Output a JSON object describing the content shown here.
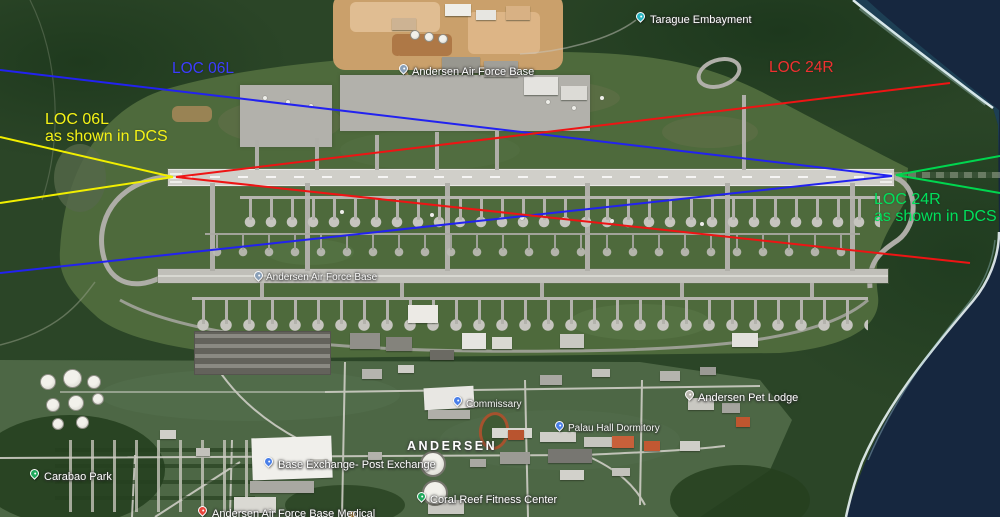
{
  "map": {
    "description": "Satellite view of Andersen Air Force Base, Guam, with localizer comparison overlay"
  },
  "annotations": {
    "colors": {
      "loc06l_real": "#2e2ef5",
      "loc24r_real": "#ee1414",
      "loc06l_dcs": "#f2ef0a",
      "loc24r_dcs": "#00d64f"
    },
    "texts": [
      {
        "id": "loc06l-real",
        "lines": [
          "LOC 06L"
        ],
        "color": "#3c3cff",
        "x": 172,
        "y": 61,
        "size": 15.5
      },
      {
        "id": "loc24r-real",
        "lines": [
          "LOC 24R"
        ],
        "color": "#f03030",
        "x": 769,
        "y": 60,
        "size": 15.5
      },
      {
        "id": "loc06l-dcs",
        "lines": [
          "LOC 06L",
          "as shown in DCS"
        ],
        "color": "#f5f216",
        "x": 45,
        "y": 111,
        "size": 16
      },
      {
        "id": "loc24r-dcs",
        "lines": [
          "LOC 24R",
          "as shown in DCS"
        ],
        "color": "#00e05c",
        "x": 874,
        "y": 191,
        "size": 16
      }
    ],
    "lines": [
      {
        "id": "loc06l-real-upper",
        "color": "#2222f0",
        "x1": 0,
        "y1": 70,
        "x2": 892,
        "y2": 176
      },
      {
        "id": "loc06l-real-lower",
        "color": "#2222f0",
        "x1": 0,
        "y1": 273,
        "x2": 892,
        "y2": 176
      },
      {
        "id": "loc24r-real-upper",
        "color": "#ee1414",
        "x1": 176,
        "y1": 177,
        "x2": 950,
        "y2": 83
      },
      {
        "id": "loc24r-real-lower",
        "color": "#ee1414",
        "x1": 176,
        "y1": 177,
        "x2": 970,
        "y2": 263
      },
      {
        "id": "loc06l-dcs-upper",
        "color": "#f2ef00",
        "x1": 0,
        "y1": 137,
        "x2": 173,
        "y2": 177
      },
      {
        "id": "loc06l-dcs-lower",
        "color": "#f2ef00",
        "x1": 0,
        "y1": 203,
        "x2": 173,
        "y2": 177
      },
      {
        "id": "loc24r-dcs-upper",
        "color": "#00d64f",
        "x1": 896,
        "y1": 175,
        "x2": 1000,
        "y2": 156
      },
      {
        "id": "loc24r-dcs-lower",
        "color": "#00d64f",
        "x1": 896,
        "y1": 175,
        "x2": 1000,
        "y2": 193
      }
    ]
  },
  "map_labels": [
    {
      "id": "tarague-embayment",
      "text": "Tarague Embayment",
      "x": 650,
      "y": 14,
      "pin": {
        "x": 636,
        "y": 12,
        "color": "#27b3bf"
      }
    },
    {
      "id": "andersen-afb-north",
      "text": "Andersen Air Force Base",
      "x": 412,
      "y": 66,
      "pin": {
        "x": 399,
        "y": 64,
        "color": "#8aa0b8"
      }
    },
    {
      "id": "andersen-afb-field",
      "text": "Andersen Air Force Base",
      "x": 266,
      "y": 272,
      "small": true,
      "pin": {
        "x": 254,
        "y": 271,
        "color": "#8aa0b8"
      }
    },
    {
      "id": "commissary",
      "text": "Commissary",
      "x": 466,
      "y": 399,
      "small": true,
      "pin": {
        "x": 453,
        "y": 396,
        "color": "#4a7fe8"
      }
    },
    {
      "id": "andersen-pet-lodge",
      "text": "Andersen Pet Lodge",
      "x": 698,
      "y": 392,
      "pin": {
        "x": 685,
        "y": 390,
        "color": "#b8b5ad"
      }
    },
    {
      "id": "palau-hall-dormitory",
      "text": "Palau Hall Dormitory",
      "x": 568,
      "y": 423,
      "small": true,
      "pin": {
        "x": 555,
        "y": 421,
        "color": "#4a7fe8"
      }
    },
    {
      "id": "andersen-district",
      "text": "ANDERSEN",
      "x": 407,
      "y": 439,
      "district": true
    },
    {
      "id": "base-exchange",
      "text": "Base Exchange- Post Exchange",
      "x": 278,
      "y": 459,
      "pin": {
        "x": 264,
        "y": 457,
        "color": "#4a7fe8"
      }
    },
    {
      "id": "carabao-park",
      "text": "Carabao Park",
      "x": 44,
      "y": 471,
      "pin": {
        "x": 30,
        "y": 469,
        "color": "#1fa85c"
      }
    },
    {
      "id": "coral-reef-fitness",
      "text": "Coral Reef Fitness Center",
      "x": 430,
      "y": 494,
      "pin": {
        "x": 417,
        "y": 492,
        "color": "#1fa85c"
      }
    },
    {
      "id": "andersen-medical",
      "text": "Andersen Air Force Base Medical",
      "x": 212,
      "y": 508,
      "pin": {
        "x": 198,
        "y": 506,
        "color": "#e8453c"
      }
    }
  ]
}
